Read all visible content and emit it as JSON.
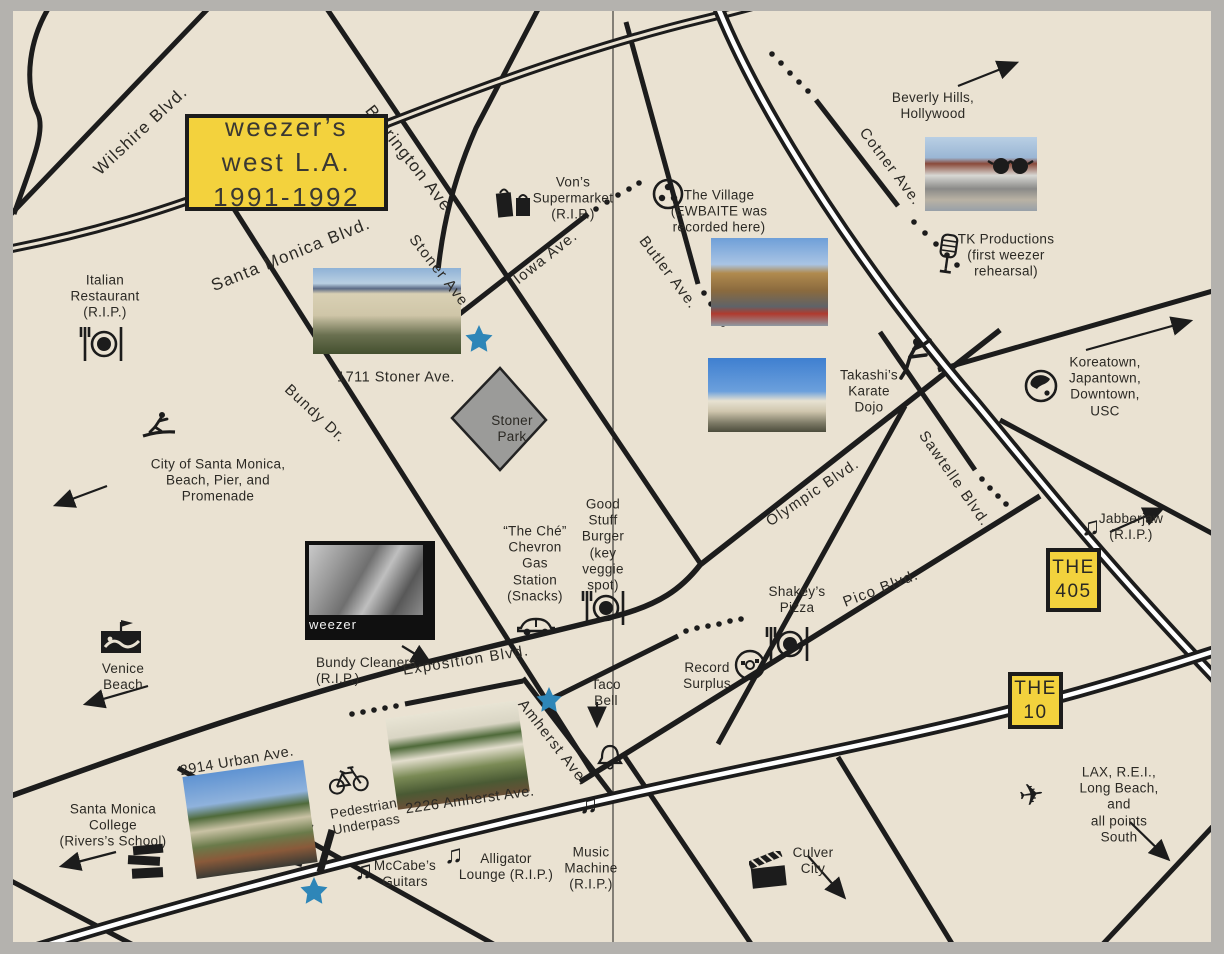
{
  "colors": {
    "background": "#eae2d2",
    "frame_border": "#b4b2ae",
    "road": "#1c1c1c",
    "highway_yellow": "#f3d23d",
    "park_gray": "#9b9b99",
    "star_blue": "#2e86b8",
    "text": "#2b2924"
  },
  "title": "weezer’s west L.A.\n1991-1992",
  "shields": {
    "i405": "THE\n405",
    "i10": "THE\n10"
  },
  "streets": {
    "wilshire": "Wilshire Blvd.",
    "santa_monica": "Santa Monica Blvd.",
    "barrington": "Barrington Ave.",
    "stoner": "Stoner Ave.",
    "iowa": "Iowa Ave.",
    "bundy": "Bundy Dr.",
    "butler": "Butler Ave.",
    "cotner": "Cotner Ave.",
    "olympic": "Olympic Blvd.",
    "sawtelle": "Sawtelle Blvd.",
    "pico": "Pico Blvd.",
    "exposition": "Exposition Blvd.",
    "amherst": "Amherst Ave."
  },
  "park": "Stoner\nPark",
  "photos": {
    "stoner_apt_caption": "1711 Stoner Ave.",
    "urban_caption": "2914 Urban Ave.",
    "amherst_caption": "2226 Amherst Ave.",
    "weezer_caption": "weezer"
  },
  "places": {
    "italian": "Italian\nRestaurant\n(R.I.P.)",
    "vons": "Von’s\nSupermarket\n(R.I.P.)",
    "village": "The Village\n(EWBAITE was\nrecorded here)",
    "tk": "TK Productions\n(first weezer\nrehearsal)",
    "takashi": "Takashi’s\nKarate\nDojo",
    "che": "“The Ché”\nChevron\nGas\nStation\n(Snacks)",
    "goodstuff": "Good\nStuff\nBurger\n(key\nveggie\nspot)",
    "shakeys": "Shakey’s\nPizza",
    "record": "Record\nSurplus",
    "taco": "Taco\nBell",
    "bundy_cleaners": "Bundy Cleaners\n(R.I.P.)",
    "jabberjaw": "Jabberjaw\n(R.I.P.)",
    "mccabes": "McCabe’s\nGuitars",
    "alligator": "Alligator\nLounge (R.I.P.)",
    "music_machine": "Music\nMachine\n(R.I.P.)",
    "underpass": "Pedestrian\nUnderpass"
  },
  "directions": {
    "santa_monica_city": "City of Santa Monica,\nBeach, Pier, and\nPromenade",
    "venice": "Venice\nBeach",
    "smc": "Santa Monica\nCollege\n(Rivers’s School)",
    "beverly": "Beverly Hills,\nHollywood",
    "koreatown": "Koreatown,\nJapantown,\nDowntown,\nUSC",
    "lax": "LAX, R.E.I.,\nLong Beach, and\nall points South",
    "culver": "Culver\nCity"
  },
  "icons": {
    "music-note": "♫",
    "airplane": "✈",
    "restaurant-plate": "fork-and-plate",
    "grocery-bags": "shopping-bags",
    "film-reel": "recording-reel",
    "sunglasses": "sunglasses",
    "microphone": "vintage-mic",
    "karate-kick": "karate-figure",
    "surfer": "surfer-figure",
    "globe": "globe",
    "boardwalk": "venice-boardwalk",
    "car": "car",
    "cd": "compact-disc",
    "bell": "bell",
    "books": "book-stack",
    "bicycle": "bicycle",
    "clapperboard": "film-clapper",
    "star": "blue-star-marker"
  }
}
